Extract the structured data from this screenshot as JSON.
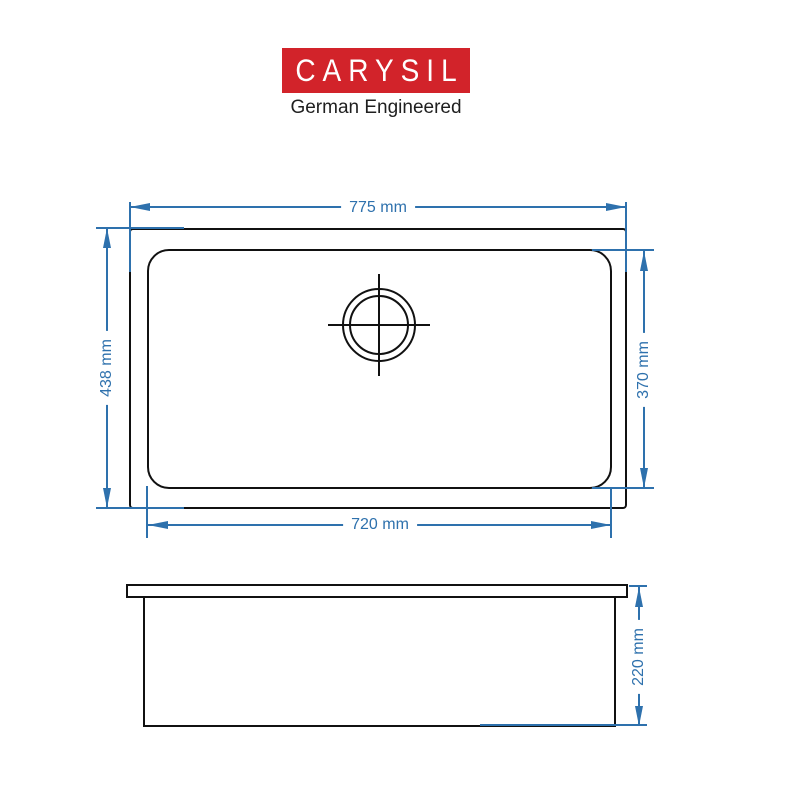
{
  "logo": {
    "brand": "CARYSIL",
    "tagline": "German Engineered",
    "brand_bg_color": "#d2232a",
    "brand_text_color": "#ffffff"
  },
  "drawing": {
    "colors": {
      "outline": "#111111",
      "dimension": "#2e71ad"
    },
    "top_view": {
      "overall_width": "775 mm",
      "overall_depth": "438 mm",
      "bowl_width": "720 mm",
      "bowl_depth": "370 mm"
    },
    "side_view": {
      "bowl_height": "220 mm"
    }
  }
}
